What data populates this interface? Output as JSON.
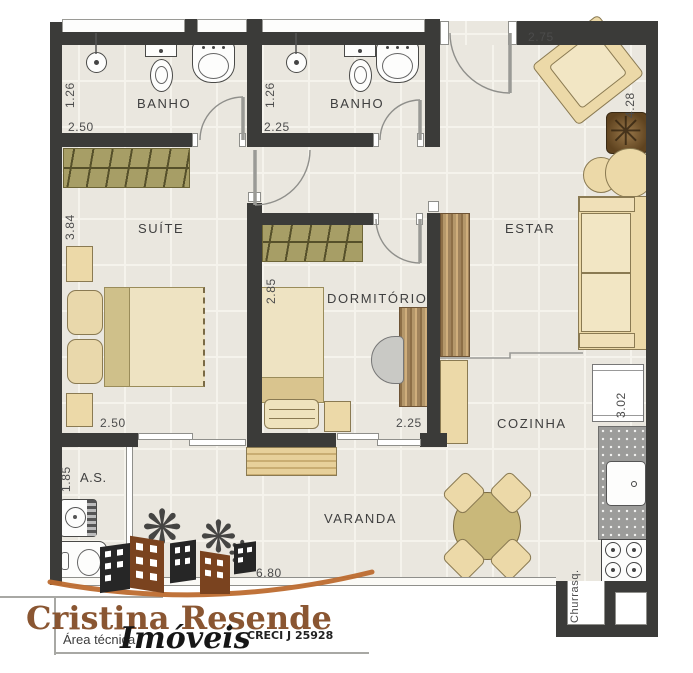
{
  "rooms": {
    "banho1": {
      "name": "BANHO",
      "width": "2.50",
      "depth": "1.26"
    },
    "banho2": {
      "name": "BANHO",
      "width": "2.25",
      "depth": "1.26"
    },
    "suite": {
      "name": "SUÍTE",
      "width": "2.50",
      "depth": "3.84"
    },
    "dormitorio": {
      "name": "DORMITÓRIO",
      "width": "2.25",
      "depth": "2.85"
    },
    "estar": {
      "name": "ESTAR",
      "width": "2.75",
      "depth": "4.28"
    },
    "cozinha": {
      "name": "COZINHA",
      "depth": "3.02"
    },
    "area_servico": {
      "name": "A.S.",
      "depth": "1.85"
    },
    "varanda": {
      "name": "VARANDA",
      "width": "6.80"
    },
    "churrasqueira": {
      "name": "Churrasq."
    }
  },
  "brand": {
    "agency": "Cristina Resende",
    "segment": "Imóveis",
    "note": "Área técnica",
    "creci": "CRECI J 25928"
  },
  "colors": {
    "wall": "#3b3b39",
    "floor": "#eae7df",
    "furniture_tan": "#ecd9a8",
    "wardrobe_olive": "#a79e66",
    "wood": "#b4976a",
    "counter_gray": "#9c9c9a",
    "brand_brown": "#8a5632",
    "accent_orange": "#bd6c2f"
  }
}
